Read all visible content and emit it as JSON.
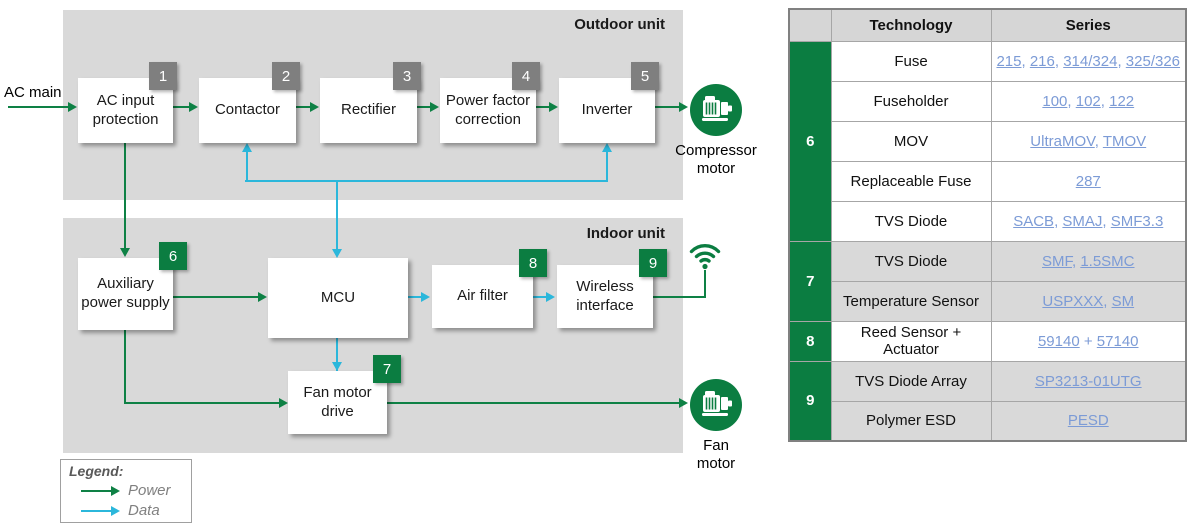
{
  "colors": {
    "power_green": "#0e8145",
    "data_cyan": "#2bb7db",
    "tag_gray": "#7f7f7f",
    "tag_green": "#0b7d41",
    "unit_box_gray": "#d9d9d9",
    "link_blue": "#7c9bd6"
  },
  "diagram": {
    "ac_main_label": "AC main",
    "outdoor": {
      "title": "Outdoor unit",
      "blocks": [
        {
          "num": "1",
          "label": "AC input protection"
        },
        {
          "num": "2",
          "label": "Contactor"
        },
        {
          "num": "3",
          "label": "Rectifier"
        },
        {
          "num": "4",
          "label": "Power factor correction"
        },
        {
          "num": "5",
          "label": "Inverter"
        }
      ],
      "motor_label": "Compressor motor"
    },
    "indoor": {
      "title": "Indoor unit",
      "blocks": [
        {
          "num": "6",
          "label": "Auxiliary power supply"
        },
        {
          "num": "",
          "label": "MCU"
        },
        {
          "num": "8",
          "label": "Air filter"
        },
        {
          "num": "9",
          "label": "Wireless interface"
        },
        {
          "num": "7",
          "label": "Fan motor drive"
        }
      ],
      "motor_label": "Fan motor"
    },
    "legend": {
      "title": "Legend:",
      "power_label": "Power",
      "data_label": "Data"
    }
  },
  "table": {
    "headers": {
      "technology": "Technology",
      "series": "Series"
    },
    "groups": [
      {
        "num": "6",
        "rows": [
          {
            "tech": "Fuse",
            "links": [
              "215",
              "216",
              "314/324",
              "325/326"
            ],
            "separator": ", "
          },
          {
            "tech": "Fuseholder",
            "links": [
              "100",
              "102",
              "122"
            ],
            "separator": ", "
          },
          {
            "tech": "MOV",
            "links": [
              "UltraMOV",
              "TMOV"
            ],
            "separator": ", "
          },
          {
            "tech": "Replaceable Fuse",
            "links": [
              "287"
            ],
            "separator": ", "
          },
          {
            "tech": "TVS Diode",
            "links": [
              "SACB",
              "SMAJ",
              "SMF3.3"
            ],
            "separator": ", "
          }
        ]
      },
      {
        "num": "7",
        "rows": [
          {
            "tech": "TVS Diode",
            "links": [
              "SMF",
              "1.5SMC"
            ],
            "separator": ", "
          },
          {
            "tech": "Temperature Sensor",
            "links": [
              "USPXXX",
              "SM"
            ],
            "separator": ", "
          }
        ]
      },
      {
        "num": "8",
        "rows": [
          {
            "tech": "Reed Sensor + Actuator",
            "links": [
              "59140",
              "57140"
            ],
            "separator": " + "
          }
        ]
      },
      {
        "num": "9",
        "rows": [
          {
            "tech": "TVS Diode Array",
            "links": [
              "SP3213-01UTG"
            ],
            "separator": ", "
          },
          {
            "tech": "Polymer ESD",
            "links": [
              "PESD"
            ],
            "separator": ", "
          }
        ]
      }
    ]
  }
}
